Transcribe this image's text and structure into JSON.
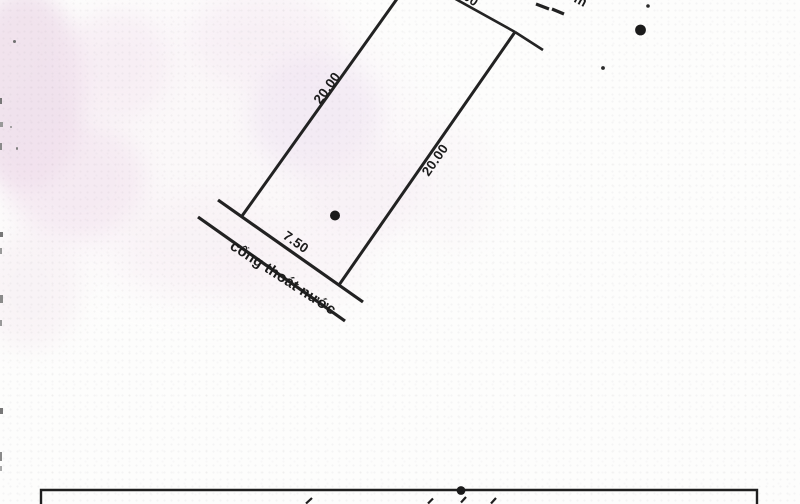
{
  "sketch": {
    "dim_left_edge": "20.00",
    "dim_right_edge": "20.00",
    "dim_frontage": "7.50",
    "dim_top_partial": "00",
    "drain_label": "cống thoát nước",
    "top_truncated_glyph": "m",
    "ink_color": "#222222",
    "watermark_color": "#f0dfec",
    "paper_color": "#fdfdfc"
  }
}
